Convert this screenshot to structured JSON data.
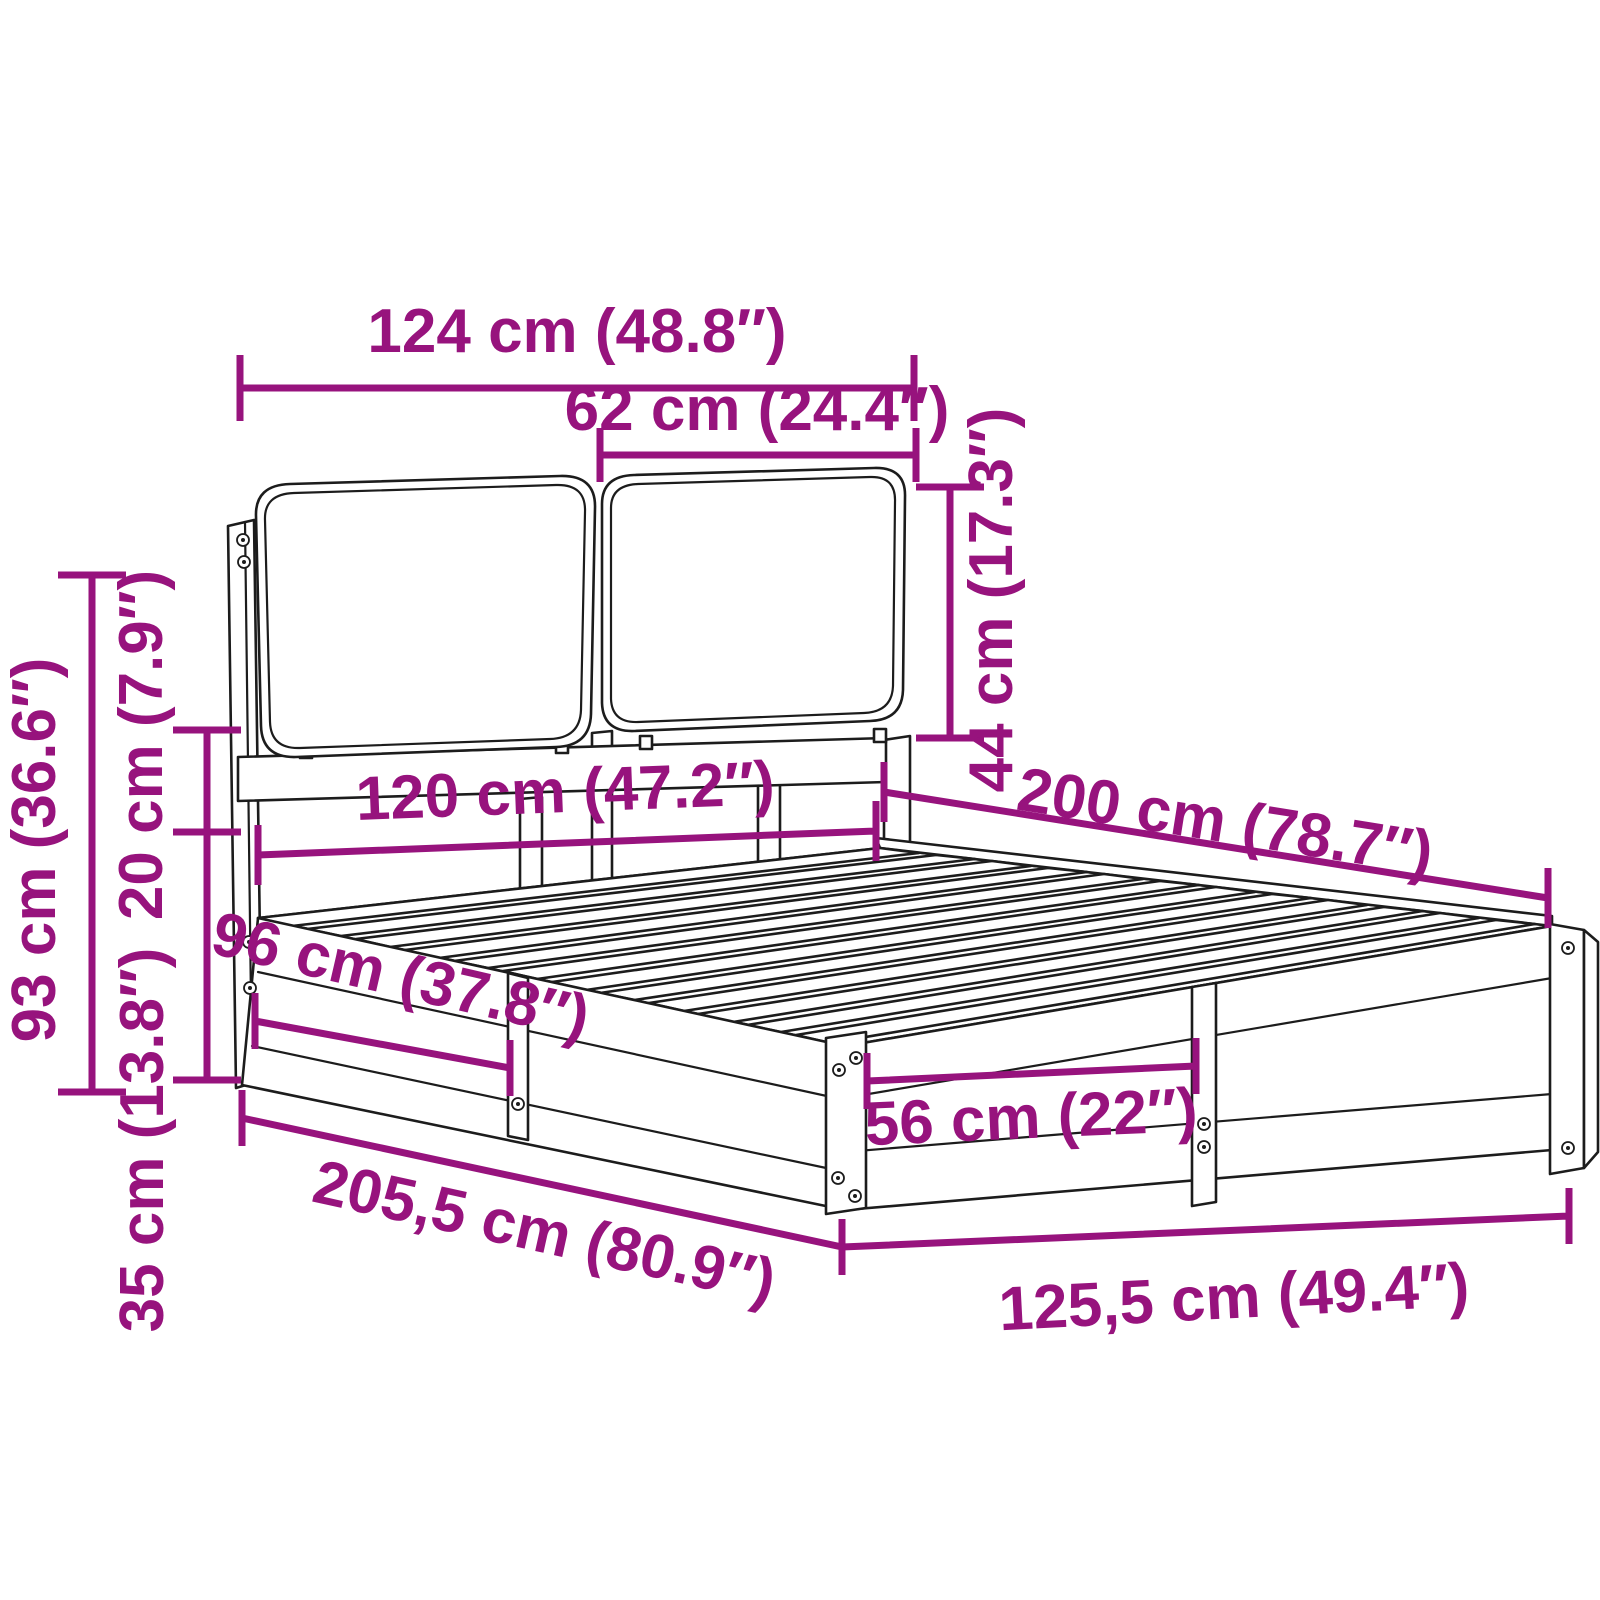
{
  "diagram": {
    "kind": "product-dimension-diagram",
    "subject": "bed-frame-with-cushion-headboard",
    "background_color": "#ffffff",
    "accent_color": "#97137D",
    "line_color": "#1c1c1c",
    "dimensions": [
      {
        "id": "headboard-total-width",
        "label": "124 cm (48.8″)"
      },
      {
        "id": "cushion-width",
        "label": "62 cm (24.4″)"
      },
      {
        "id": "cushion-height",
        "label": "44 cm (17.3″)"
      },
      {
        "id": "headboard-total-height",
        "label": "93 cm (36.6″)"
      },
      {
        "id": "headboard-gap-height",
        "label": "20 cm (7.9″)"
      },
      {
        "id": "frame-side-height",
        "label": "35 cm (13.8″)"
      },
      {
        "id": "bed-inner-width",
        "label": "120 cm (47.2″)"
      },
      {
        "id": "bed-inner-length",
        "label": "200 cm (78.7″)"
      },
      {
        "id": "side-panel-length",
        "label": "96 cm (37.8″)"
      },
      {
        "id": "front-panel-length",
        "label": "56 cm (22″)"
      },
      {
        "id": "overall-length",
        "label": "205,5 cm (80.9″)"
      },
      {
        "id": "overall-width",
        "label": "125,5 cm (49.4″)"
      }
    ]
  }
}
